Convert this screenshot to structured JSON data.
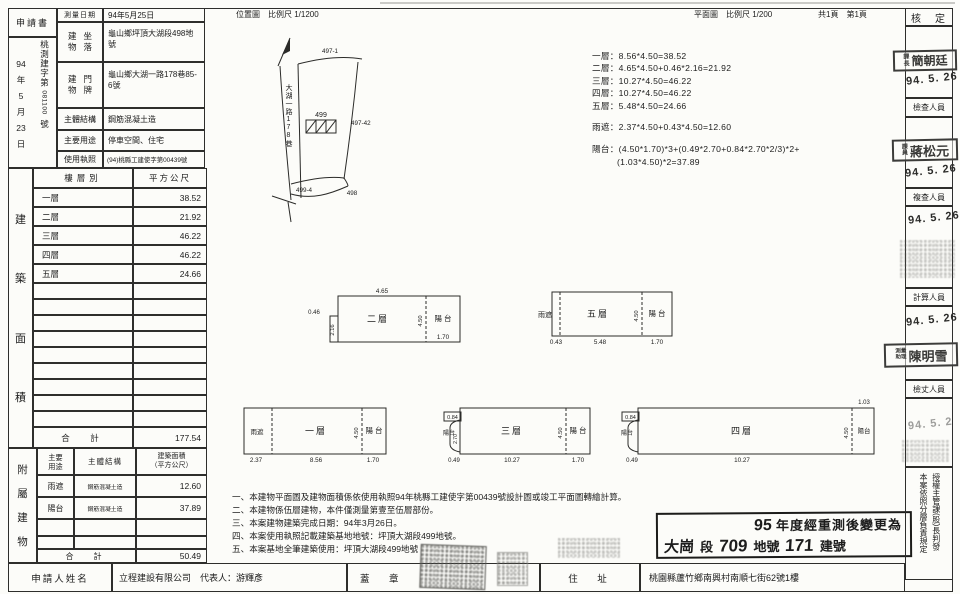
{
  "header": {
    "application_label": "申請書",
    "received_date_parts": [
      "94",
      "年",
      "5",
      "月",
      "23",
      "日"
    ],
    "received_no_prefix": "桃測建字第",
    "received_no": "081100",
    "received_no_suffix": "號",
    "survey_date_label": "測量日期",
    "survey_date": "94年5月25日",
    "situs_label": "建物坐落",
    "situs": "龜山鄉坪頂大湖段498地號",
    "doorplate_label": "建物門牌",
    "doorplate": "龜山鄉大湖一路178巷85-6號",
    "structure_label": "主體結構",
    "structure": "鋼筋混凝土造",
    "use_label": "主要用途",
    "use": "停車空間、住宅",
    "license_label": "使用執照",
    "license": "(94)桃縣工建使字第00439號"
  },
  "titles": {
    "location_map": "位置圖　比例尺 1/1200",
    "floor_plan": "平面圖　比例尺 1/200",
    "pages": "共1頁　第1頁"
  },
  "building_area": {
    "side_label": "建築面積",
    "col_floor": "樓層別",
    "col_sqm": "平方公尺",
    "rows": [
      [
        "一層",
        "38.52"
      ],
      [
        "二層",
        "21.92"
      ],
      [
        "三層",
        "46.22"
      ],
      [
        "四層",
        "46.22"
      ],
      [
        "五層",
        "24.66"
      ]
    ],
    "total_label": "合　計",
    "total": "177.54"
  },
  "annex": {
    "side_label": "附屬建物",
    "col_use": "主要\n用途",
    "col_structure": "主體結構",
    "col_area": "建築面積\n（平方公尺）",
    "rows": [
      [
        "雨遮",
        "鋼筋混凝土造",
        "12.60"
      ],
      [
        "陽台",
        "鋼筋混凝土造",
        "37.89"
      ]
    ],
    "total_label": "合　計",
    "total": "50.49"
  },
  "applicant": {
    "name_label": "申請人姓名",
    "name": "立程建設有限公司　代表人：游輝彥",
    "seal_label": "蓋　章",
    "address_label": "住　址",
    "address": "桃園縣蘆竹鄉南興村南順七街62號1樓"
  },
  "calc": {
    "floors": [
      "一層：8.56*4.50=38.52",
      "二層：4.65*4.50+0.46*2.16=21.92",
      "三層：10.27*4.50=46.22",
      "四層：10.27*4.50=46.22",
      "五層：5.48*4.50=24.66"
    ],
    "rain": "雨遮：2.37*4.50+0.43*4.50=12.60",
    "balcony_1": "陽台：(4.50*1.70)*3+(0.49*2.70+0.84*2.70*2/3)*2+",
    "balcony_2": "(1.03*4.50)*2=37.89"
  },
  "notes": [
    "一、本建物平面圖及建物面積係依使用執照94年桃縣工建使字第00439號設計圖或竣工平面圖轉繪計算。",
    "二、本建物係伍層建物，本件僅測量第壹至伍層部份。",
    "三、本案建物建築完成日期：94年3月26日。",
    "四、本案使用執照記載建築基地地號：坪頂大湖段499地號。",
    "五、本案基地全筆建築使用：坪頂大湖段499地號"
  ],
  "approval": {
    "header": "核　定",
    "check_label": "檢查人員",
    "recheck_label": "複查人員",
    "calc_label": "計算人員",
    "measure_label": "檢丈人員",
    "chief_role": "課長",
    "chief_name": "簡朝廷",
    "chief_date": "94. 5. 26",
    "check_prefix": "課員",
    "check_name": "蔣松元",
    "check_date": "94. 5. 26",
    "recheck_date": "94. 5. 26",
    "calc_prefix": "測量助理",
    "calc_name": "陳明雪",
    "calc_date": "94. 5. 26",
    "measure_date": "94. 5. 2",
    "footnote_col1": "本案依照分層負責規定",
    "footnote_col2": "授權主管課(股)長判發"
  },
  "restamp": {
    "num": "95",
    "line1": "年度經重測後變更為",
    "sec_hand": "大崗",
    "sec_label": "段",
    "parcel_hand": "709",
    "parcel_label": "地號",
    "bldg_hand": "171",
    "bldg_label": "建號"
  },
  "site_map": {
    "road": "大湖一路178巷",
    "parcel_top": "497-1",
    "parcel_right": "497-42",
    "parcel_center": "499",
    "parcel_bottom": "499-4",
    "parcel_bottom_right": "498"
  },
  "plans": {
    "f1": {
      "label": "一層",
      "rain": "雨遮",
      "balcony": "陽 台",
      "w_rain": "2.37",
      "w_main": "8.56",
      "w_bal": "1.70",
      "h": "4.50"
    },
    "f2": {
      "label": "二層",
      "balcony": "陽 台",
      "w_main": "4.65",
      "notch_w": "0.46",
      "notch_h": "2.16",
      "w_bal": "1.70",
      "h": "4.50"
    },
    "f3": {
      "label": "三層",
      "balcony": "陽 台",
      "balcony_left": "陽台",
      "bump_w": "0.84",
      "bump_h": "2.70",
      "bump_b": "0.49",
      "w_main": "10.27",
      "w_bal": "1.70",
      "h": "4.50"
    },
    "f4": {
      "label": "四層",
      "balcony": "陽台",
      "balcony_left": "陽台",
      "bump_w": "0.84",
      "bump_b": "0.49",
      "w_main": "10.27",
      "w_bal_top": "1.03",
      "h": "4.50"
    },
    "f5": {
      "label": "五層",
      "rain": "雨遮",
      "balcony": "陽 台",
      "w_rain": "0.43",
      "w_main": "5.48",
      "w_bal": "1.70",
      "h": "4.50"
    }
  }
}
